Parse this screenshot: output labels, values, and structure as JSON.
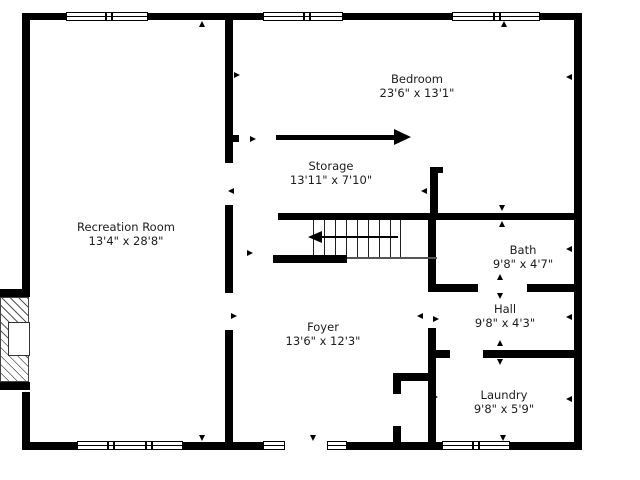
{
  "floor_plan": {
    "rooms": [
      {
        "name": "Recreation Room",
        "dimensions": "13'4\" x 28'8\""
      },
      {
        "name": "Bedroom",
        "dimensions": "23'6\" x 13'1\""
      },
      {
        "name": "Storage",
        "dimensions": "13'11\" x 7'10\""
      },
      {
        "name": "Bath",
        "dimensions": "9'8\" x 4'7\""
      },
      {
        "name": "Hall",
        "dimensions": "9'8\" x 4'3\""
      },
      {
        "name": "Foyer",
        "dimensions": "13'6\" x 12'3\""
      },
      {
        "name": "Laundry",
        "dimensions": "9'8\" x 5'9\""
      }
    ],
    "colors": {
      "wall": "#000000",
      "background": "#ffffff",
      "text": "#1c1c1c"
    }
  }
}
